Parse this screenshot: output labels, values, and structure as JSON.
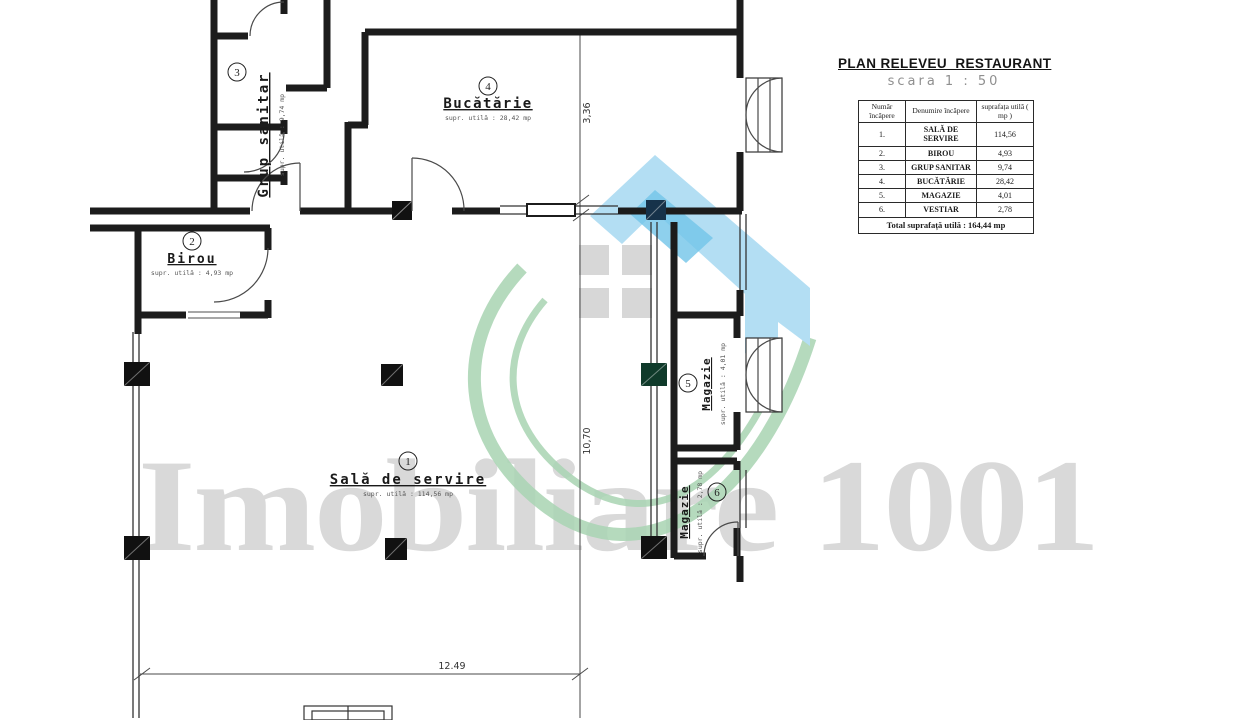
{
  "title_block": {
    "title": "PLAN RELEVEU  RESTAURANT",
    "scale": "scara 1 : 50"
  },
  "table": {
    "headers": [
      "Număr încăpere",
      "Denumire încăpere",
      "suprafața utilă ( mp )"
    ],
    "rows": [
      {
        "num": "1.",
        "name": "SALĂ DE SERVIRE",
        "area": "114,56"
      },
      {
        "num": "2.",
        "name": "BIROU",
        "area": "4,93"
      },
      {
        "num": "3.",
        "name": "GRUP SANITAR",
        "area": "9,74"
      },
      {
        "num": "4.",
        "name": "BUCĂTĂRIE",
        "area": "28,42"
      },
      {
        "num": "5.",
        "name": "MAGAZIE",
        "area": "4,01"
      },
      {
        "num": "6.",
        "name": "VESTIAR",
        "area": "2,78"
      }
    ],
    "total": "Total suprafață utilă : 164,44 mp"
  },
  "rooms": [
    {
      "number": "1",
      "label": "Sală de servire",
      "area_label": "supr. utilă : 114,56 mp"
    },
    {
      "number": "2",
      "label": "Birou",
      "area_label": "supr. utilă : 4,93 mp"
    },
    {
      "number": "3",
      "label": "Grup sanitar",
      "area_label": "supr. utilă : 9,74 mp"
    },
    {
      "number": "4",
      "label": "Bucătărie",
      "area_label": "supr. utilă : 28,42 mp"
    },
    {
      "number": "5",
      "label": "Magazie",
      "area_label": "supr. utilă : 4,01 mp"
    },
    {
      "number": "6",
      "label": "Magazie",
      "area_label": "supr. utilă : 2,78 mp"
    }
  ],
  "dimensions": {
    "vertical_kitchen": "3,36",
    "vertical_hall": "10,70",
    "horizontal_bottom": "12.49"
  },
  "watermark": "Imobiliare 1001",
  "colors": {
    "wall": "#1c1c1c",
    "logo_light_blue": "#a9daf2",
    "logo_blue": "#5fbde6",
    "logo_green": "#abd5b5",
    "logo_window_gray": "#d2d2d2",
    "watermark_gray": "#d9d9d9"
  }
}
